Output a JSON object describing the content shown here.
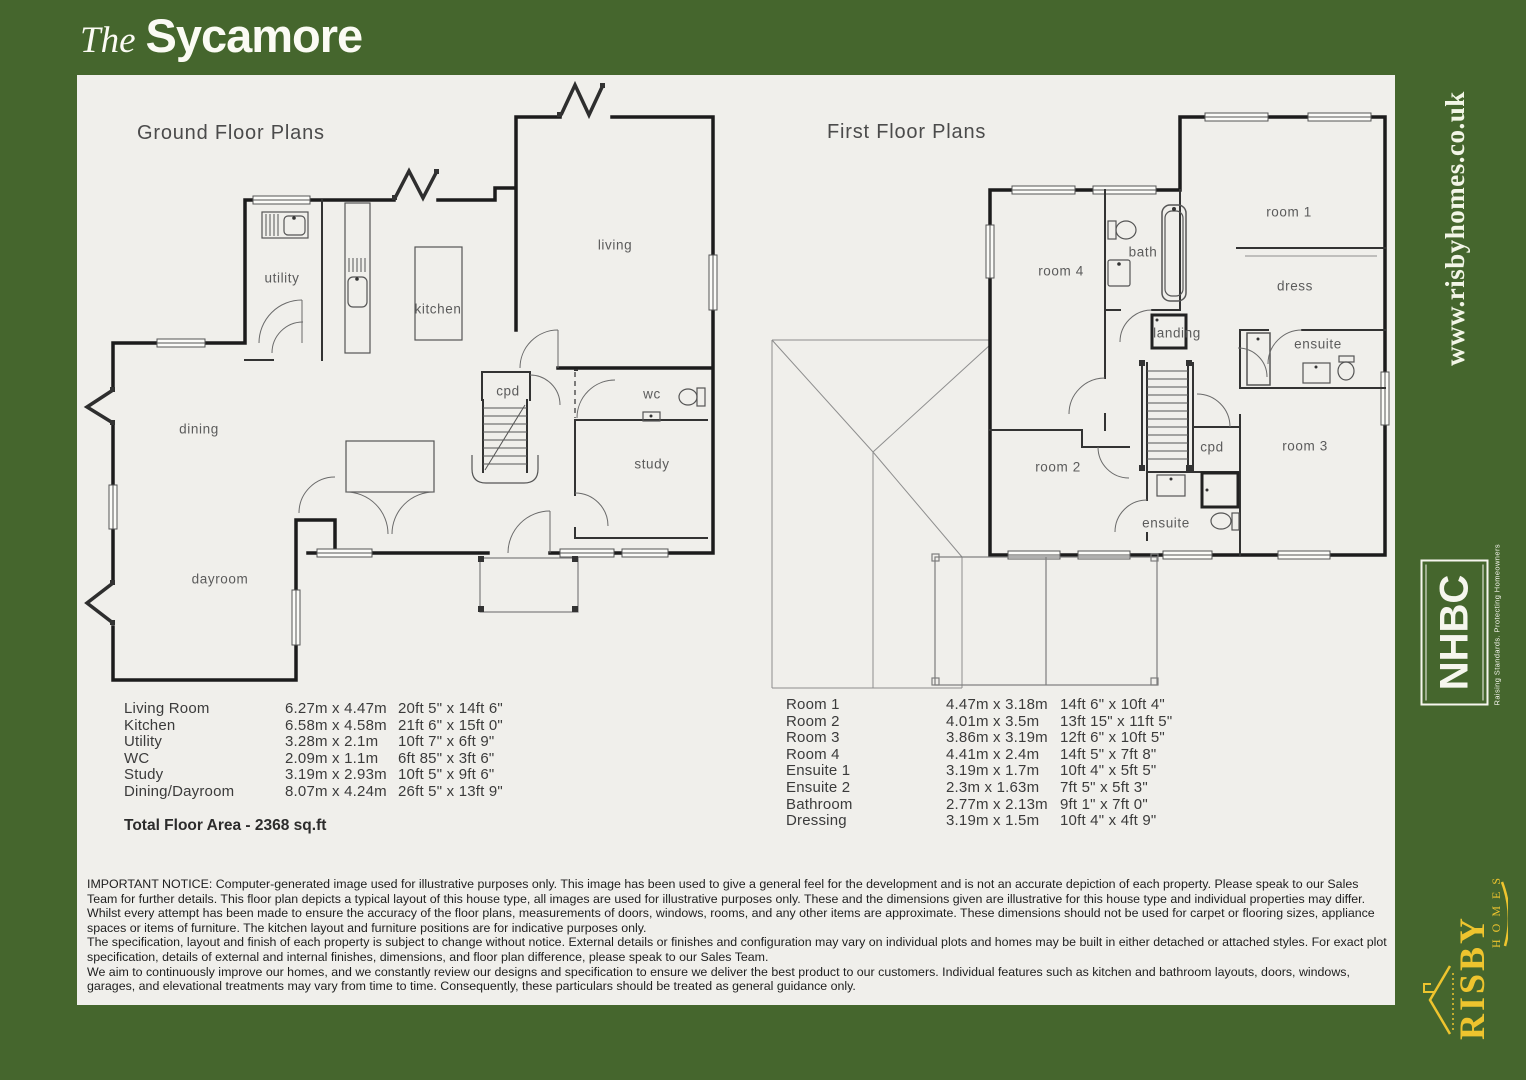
{
  "title": {
    "prefix": "The",
    "name": "Sycamore"
  },
  "ground_floor": {
    "title": "Ground Floor Plans",
    "rooms": {
      "utility": "utility",
      "kitchen": "kitchen",
      "living": "living",
      "cpd": "cpd",
      "wc": "wc",
      "study": "study",
      "dining": "dining",
      "dayroom": "dayroom"
    }
  },
  "first_floor": {
    "title": "First Floor Plans",
    "rooms": {
      "room4": "room 4",
      "bath": "bath",
      "room1": "room 1",
      "dress": "dress",
      "landing": "landing",
      "ensuite1": "ensuite",
      "room2": "room 2",
      "cpd": "cpd",
      "room3": "room 3",
      "ensuite2": "ensuite"
    }
  },
  "ground_table": {
    "rows": [
      {
        "name": "Living Room",
        "metric": "6.27m x 4.47m",
        "imperial": "20ft 5\" x 14ft 6\""
      },
      {
        "name": "Kitchen",
        "metric": "6.58m x 4.58m",
        "imperial": "21ft 6\" x 15ft 0\""
      },
      {
        "name": "Utility",
        "metric": "3.28m x 2.1m",
        "imperial": "10ft 7\" x 6ft 9\""
      },
      {
        "name": "WC",
        "metric": "2.09m x 1.1m",
        "imperial": "6ft 85\" x 3ft 6\""
      },
      {
        "name": "Study",
        "metric": "3.19m x 2.93m",
        "imperial": "10ft 5\" x 9ft 6\""
      },
      {
        "name": "Dining/Dayroom",
        "metric": "8.07m x 4.24m",
        "imperial": "26ft 5\" x 13ft 9\""
      }
    ],
    "total": "Total Floor Area - 2368 sq.ft"
  },
  "first_table": {
    "rows": [
      {
        "name": "Room  1",
        "metric": "4.47m x 3.18m",
        "imperial": "14ft 6\" x 10ft 4\""
      },
      {
        "name": "Room  2",
        "metric": "4.01m x 3.5m",
        "imperial": "13ft 15\" x 11ft 5\""
      },
      {
        "name": "Room  3",
        "metric": "3.86m x 3.19m",
        "imperial": "12ft 6\" x 10ft 5\""
      },
      {
        "name": "Room  4",
        "metric": "4.41m x 2.4m",
        "imperial": "14ft 5\" x 7ft 8\""
      },
      {
        "name": "Ensuite 1",
        "metric": "3.19m x 1.7m",
        "imperial": "10ft 4\" x 5ft 5\""
      },
      {
        "name": "Ensuite 2",
        "metric": "2.3m x 1.63m",
        "imperial": "7ft 5\" x 5ft 3\""
      },
      {
        "name": "Bathroom",
        "metric": "2.77m x 2.13m",
        "imperial": "9ft 1\" x 7ft 0\""
      },
      {
        "name": "Dressing",
        "metric": "3.19m x 1.5m",
        "imperial": "10ft 4\" x 4ft 9\""
      }
    ]
  },
  "notice": {
    "p1": "IMPORTANT NOTICE: Computer-generated image used for illustrative purposes only. This image has been used to give a general feel for the development and is not an accurate depiction of each property. Please speak to our Sales Team for further details. This floor plan depicts a typical layout of this house type, all images are used for illustrative purposes only. These and the dimensions given are illustrative for this house type and individual properties may differ. Whilst every attempt has been made to ensure the accuracy of the floor plans, measurements of doors, windows, rooms, and any other items are approximate. These dimensions should not be used for carpet or flooring sizes, appliance spaces or items of furniture. The kitchen layout and furniture positions are for indicative purposes only.",
    "p2": "The specification, layout and finish of each property is subject to change without notice. External details or finishes and configuration may vary on individual plots and homes may be built in either detached or attached styles. For exact plot specification, details of external and internal finishes, dimensions, and floor plan difference, please speak to our Sales Team.",
    "p3": "We aim to continuously improve our homes, and we constantly review our designs and specification to ensure we deliver the best product to our customers. Individual features such as kitchen and bathroom layouts, doors, windows, garages, and elevational treatments may vary from time to time. Consequently, these particulars should be treated as general guidance only."
  },
  "sidebar": {
    "website": "www.risbyhomes.co.uk",
    "nhbc": {
      "name": "NHBC",
      "tagline": "Raising Standards. Protecting Homeowners"
    },
    "risby": {
      "name": "RISBY",
      "homes": "H O M E S"
    }
  },
  "colors": {
    "green": "#45662d",
    "paper": "#f0efeb",
    "gold": "#eec42e"
  }
}
